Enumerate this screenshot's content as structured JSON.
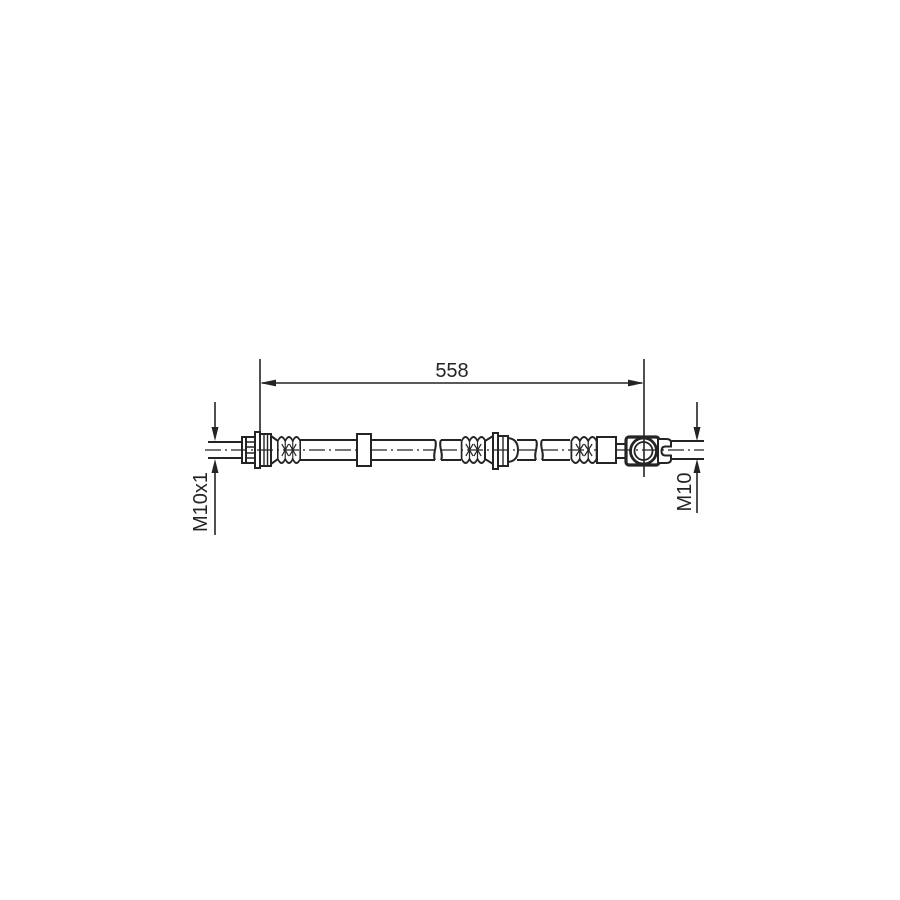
{
  "diagram": {
    "length_label": "558",
    "left_thread_label": "M10x1",
    "right_thread_label": "M10"
  },
  "colors": {
    "line": "#242424",
    "background": "#ffffff"
  }
}
